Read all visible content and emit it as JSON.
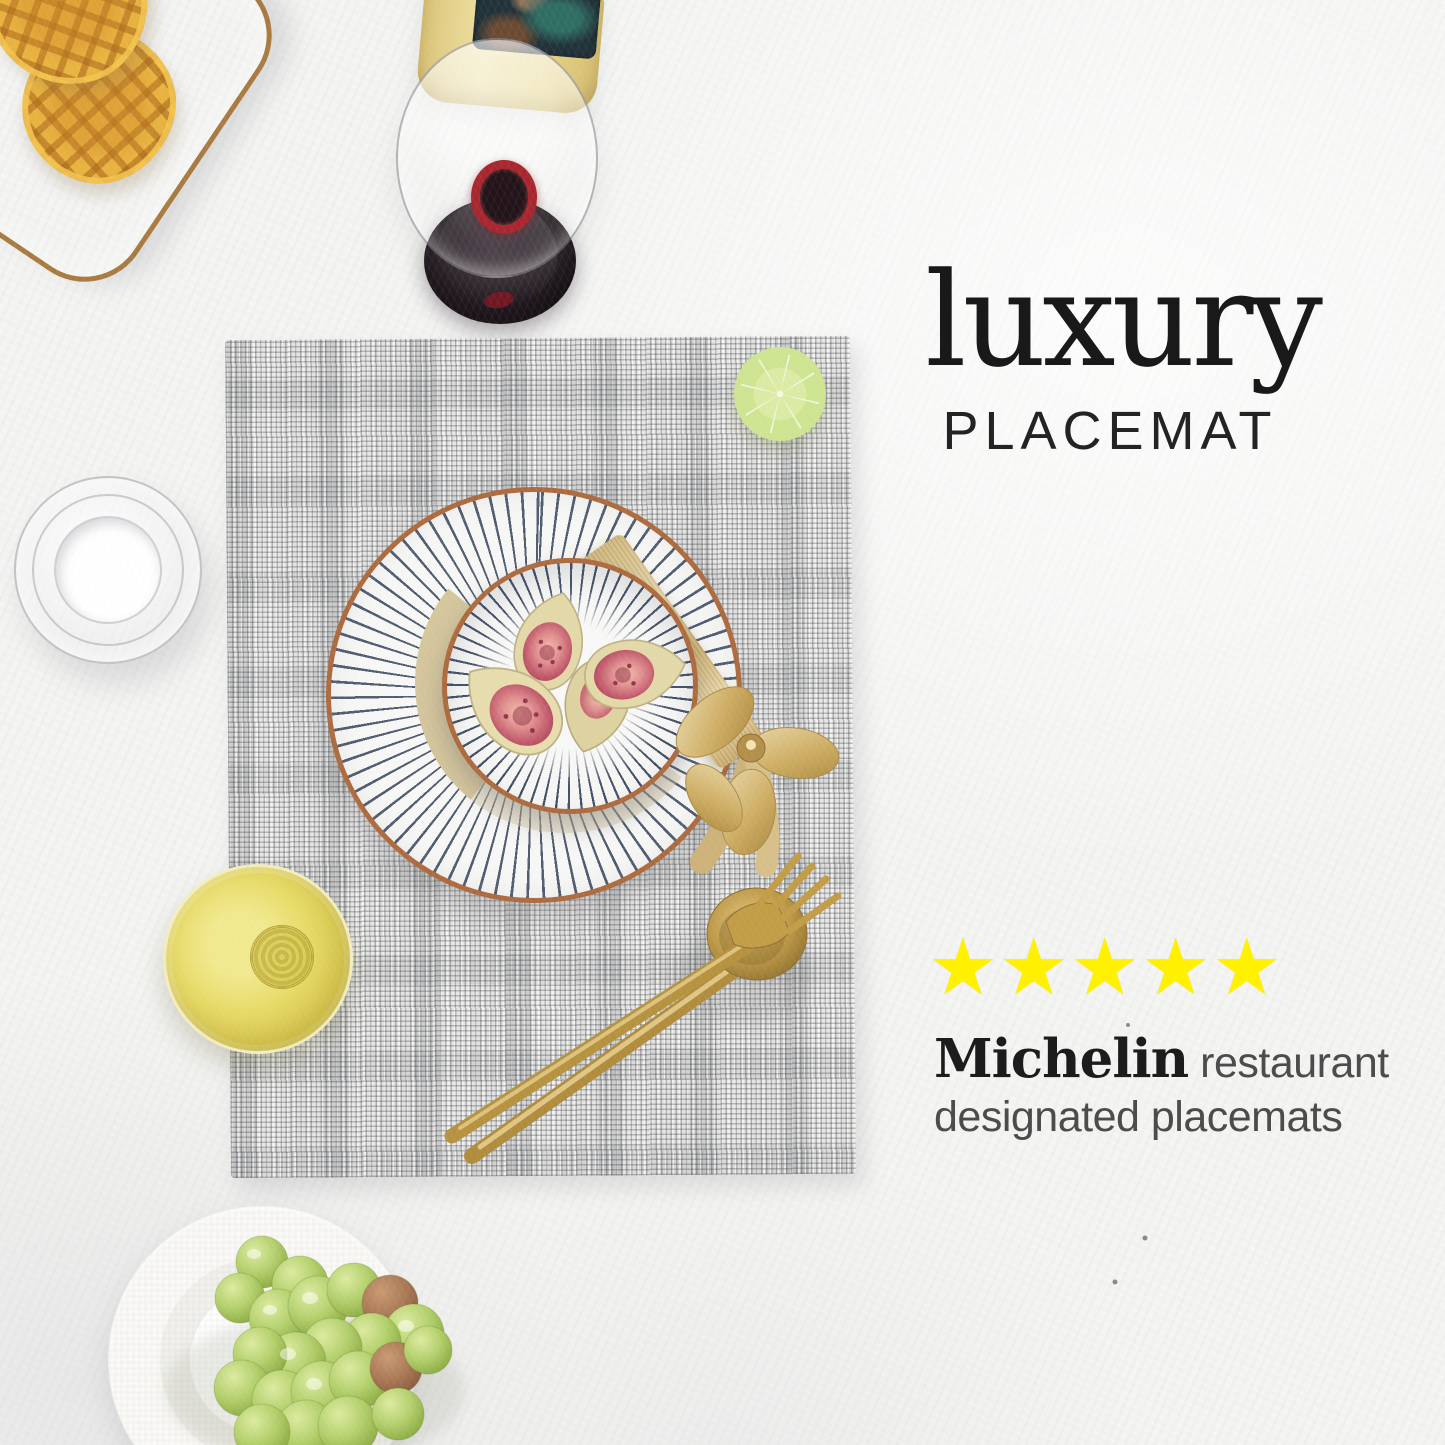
{
  "overlay": {
    "title": "luxury",
    "subtitle": "PLACEMAT",
    "rating": {
      "stars": "★★★★★",
      "count": 5
    },
    "tagline": {
      "brand": "Michelin",
      "suffix": "restaurant",
      "line2": "designated placemats"
    }
  },
  "colors": {
    "star_yellow": "#FFF100",
    "headline_black": "#191919",
    "tagline_gray": "#4C4C4C",
    "ribbon_gold": "#CDB279",
    "cutlery_gold": "#B6923F",
    "plate_rim_terracotta": "#AD6A3E",
    "plate_stripe_navy": "#2C3A54",
    "placemat_gray": "#D9D9D7",
    "tablecloth_white": "#F3F3F1",
    "lime_green": "#A6C94D",
    "grape_green": "#A9C45F",
    "waffle_yellow": "#F2C047"
  }
}
